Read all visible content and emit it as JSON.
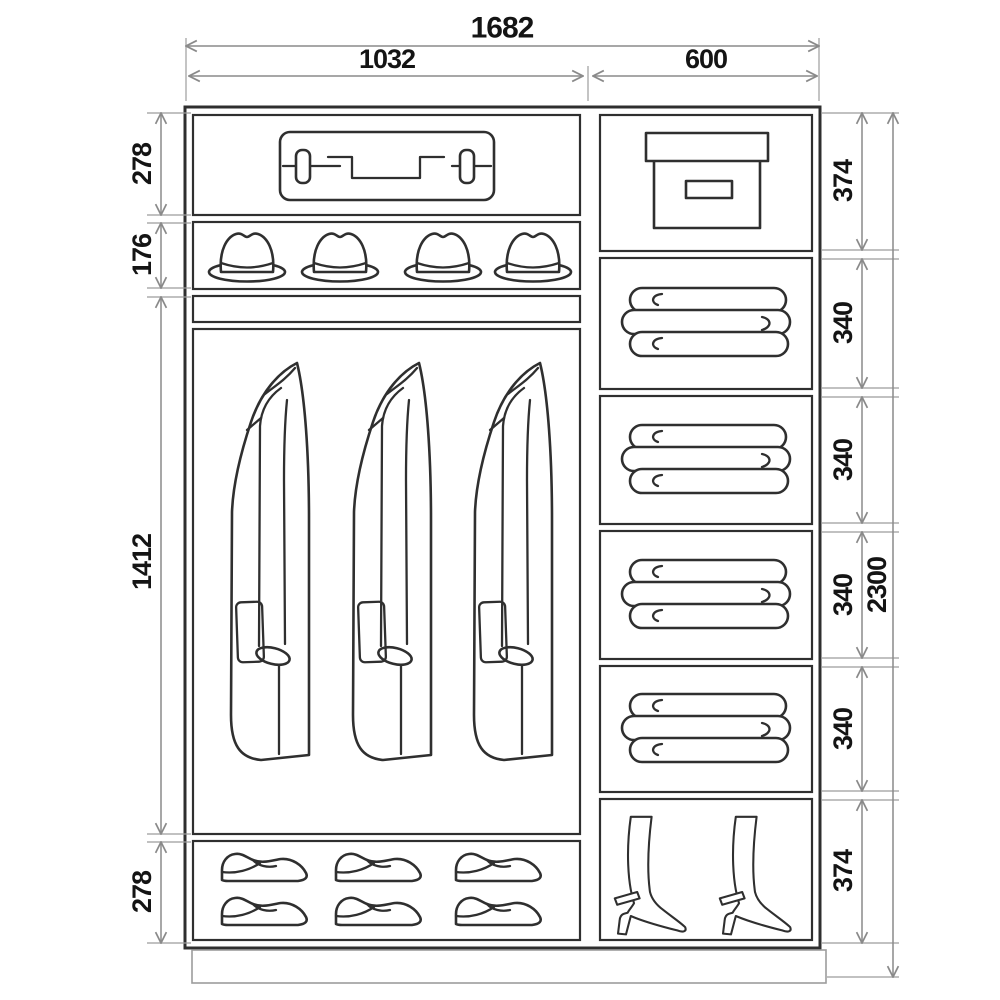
{
  "dimensions": {
    "overall_width": "1682",
    "left_section_width": "1032",
    "right_section_width": "600",
    "overall_height": "2300",
    "left_section_heights": [
      "278",
      "176",
      "1412",
      "278"
    ],
    "right_section_heights": [
      "374",
      "340",
      "340",
      "340",
      "340",
      "374"
    ]
  },
  "compartment_contents": {
    "left_column": [
      "suitcase",
      "four hats",
      "narrow shelf",
      "three hanging coats",
      "six shoes in two rows"
    ],
    "right_column": [
      "storage box",
      "folded linen",
      "folded linen",
      "folded linen",
      "folded linen",
      "two high-heel boots"
    ]
  },
  "colors": {
    "outline": "#2f2f2f",
    "dimension_line": "#8a8a8a",
    "label_text": "#141414",
    "background": "#ffffff"
  }
}
